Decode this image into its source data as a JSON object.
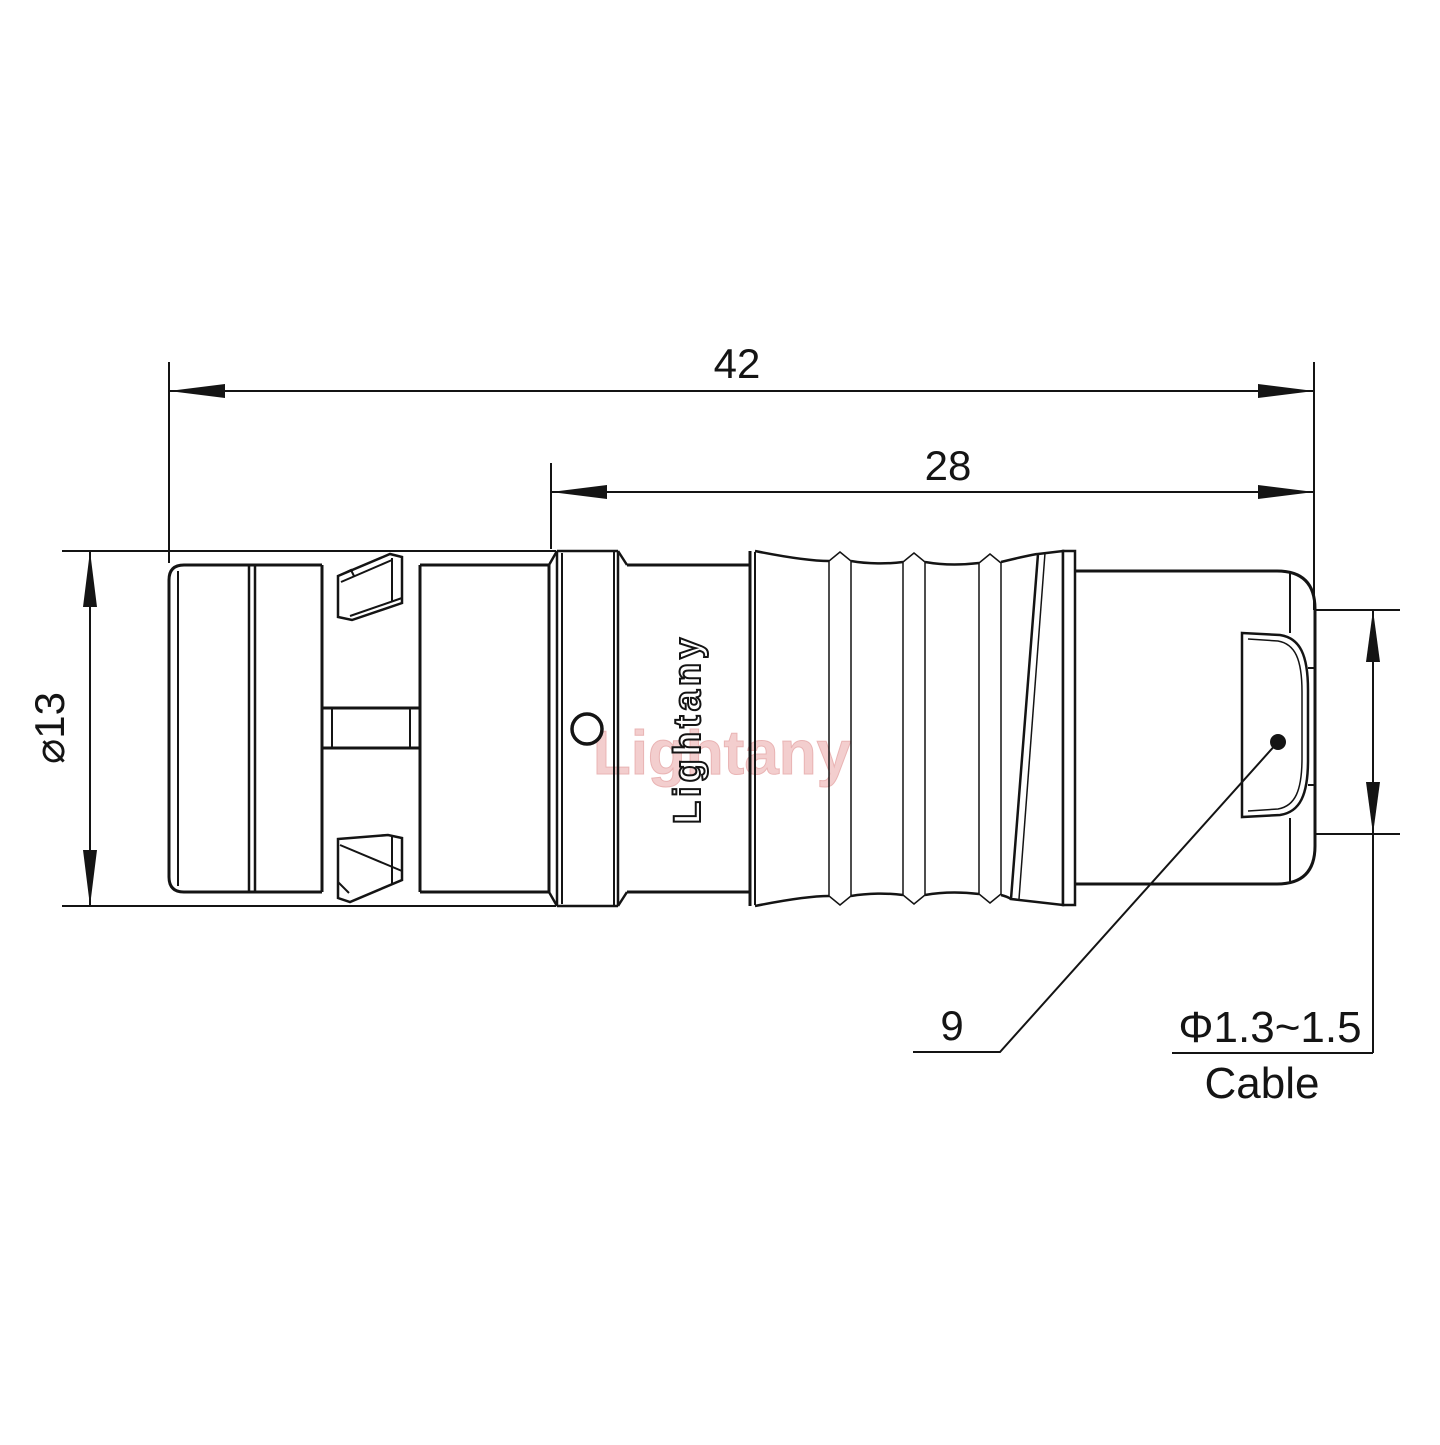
{
  "title": "Connector technical drawing",
  "dimensions": {
    "overall_length": "42",
    "rear_length": "28",
    "shell_diameter": "⌀13",
    "leader_label": "9",
    "cable_diameter": "Φ1.3~1.5",
    "cable_word": "Cable"
  },
  "branding": {
    "engraved_text": "Lightany",
    "watermark_text": "Lightany"
  },
  "colors": {
    "line": "#141414",
    "watermark_fill": "#f2c6c6",
    "background": "#ffffff"
  }
}
